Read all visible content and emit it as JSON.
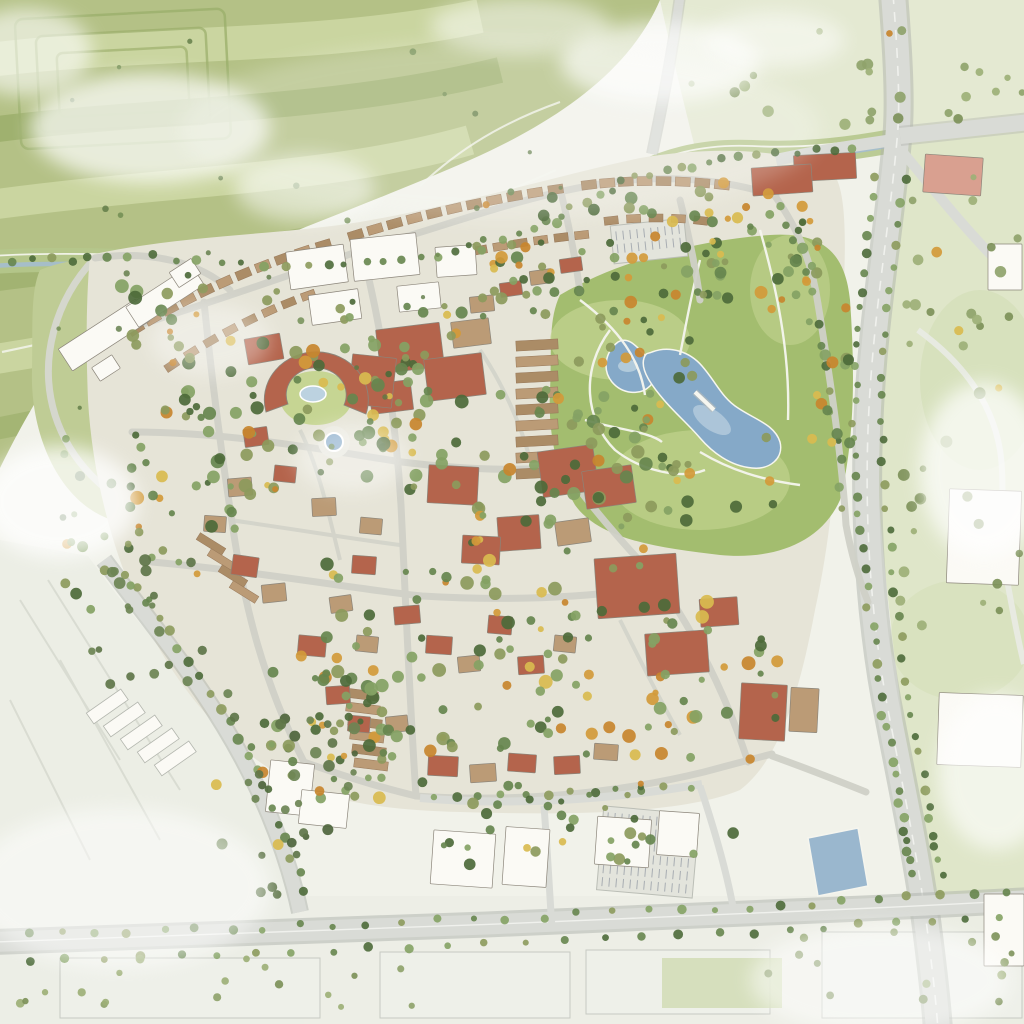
{
  "meta": {
    "description": "Hand-painted watercolor aerial master plan: a mixed-use village of terracotta- and tan-roofed buildings around a crescent amenity building with courtyard pool and a round fountain plaza; a central park with two blue ponds joined by a footbridge; arcs of townhouse rows to the north; striped farm fields in the northwest with a tree-lined greenway canal; a tree-lined arterial road and four-way intersection to the east with a salmon commercial building; white retail buildings with a parking lot and a boulevard to the south; pale industrial parcels in the southwest and southeast; soft white cloud washes over the scene."
  },
  "palette": {
    "paper": "#f1f2ea",
    "fieldGreen": "#b4c186",
    "fieldGreenDark": "#9aad69",
    "fieldGreenLight": "#cad5a0",
    "fieldPath": "#f3f4ec",
    "openLand": "#dfe6c9",
    "openLandDark": "#cfdbb2",
    "canalBand": "#b5c68c",
    "canalWater": "#a4bccf",
    "villageGround": "#e6e4d7",
    "resortLawn": "#bfcc95",
    "street": "#d0d1c8",
    "road": "#d9dbd6",
    "roadEdge": "#aeb1ac",
    "path": "#f6f6ef",
    "parkGreen": "#a3bd6f",
    "lawnLight": "#c6d593",
    "pondWater": "#85a9c8",
    "pondWaterLight": "#bcd2e0",
    "roofRed": "#b4644c",
    "roofRedDark": "#8f4733",
    "roofTan": "#bb9b76",
    "roofTanDark": "#97785a",
    "roofSalmon": "#d9a090",
    "buildingWhite": "#fbfaf5",
    "buildingShadow": "#c9cac2",
    "buildingOutline": "#8b857a",
    "treeGreen": "#66854e",
    "treeGreenDark": "#4d6a3a",
    "treeGreenLight": "#84a264",
    "treeOlive": "#8c9a5c",
    "treeOrange": "#d39a3a",
    "treeYellow": "#d9bb4f",
    "industrialPale": "#eceee5",
    "parcelPale": "#eef0e9",
    "parcelLine": "#c6c9c2",
    "tickGrey": "#9aa0a8",
    "cloud": "#ffffff"
  },
  "regions": [
    "farm-fields-northwest",
    "terraced-field-corner",
    "greenway-canal",
    "mixed-use-village-core",
    "central-park",
    "small-pond",
    "large-pond",
    "footbridge",
    "crescent-amenity-building",
    "courtyard-pool",
    "fountain-plaza",
    "townhouse-rows",
    "terracotta-apartment-blocks",
    "white-commercial-buildings-north",
    "resort-estate-west",
    "arterial-road-east",
    "four-way-intersection-northeast",
    "salmon-building-northeast",
    "south-boulevard",
    "southwest-avenue",
    "industrial-area-southwest",
    "retail-cluster-south",
    "parking-lot",
    "detention-basin",
    "big-box-buildings-east",
    "open-meadows-east",
    "cloud-washes"
  ]
}
